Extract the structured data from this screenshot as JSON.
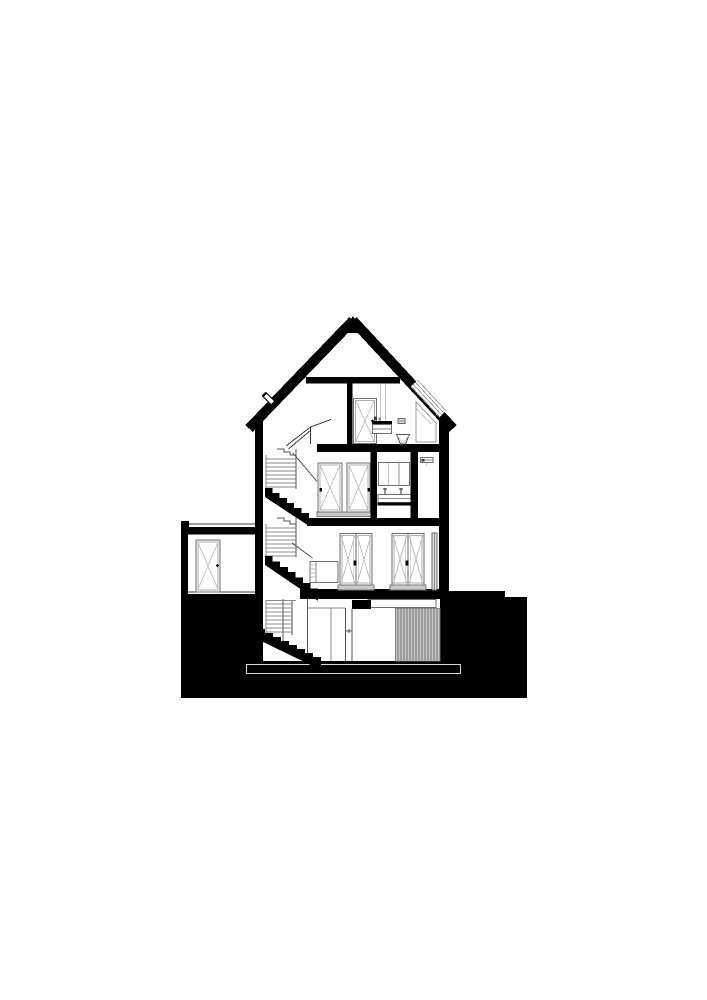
{
  "figure": {
    "kind": "architectural-cross-section",
    "orientation": "portrait",
    "visible_text": [],
    "levels": [
      {
        "name": "attic",
        "features": [
          "gable-roof",
          "collar-tie",
          "roof-window",
          "stair-bulkhead",
          "door",
          "washbasin",
          "wall-hung-wc",
          "flush-panel",
          "chimney-vent"
        ]
      },
      {
        "name": "second-floor",
        "features": [
          "stair-flight",
          "door-left",
          "door-right",
          "mirror-cabinet",
          "vanity-counter",
          "bathroom-wall",
          "closet-shelf"
        ]
      },
      {
        "name": "ground-floor",
        "features": [
          "stair-flight",
          "sideboard",
          "french-door-pair-west",
          "french-door-pair-east",
          "side-window",
          "thresholds"
        ]
      },
      {
        "name": "basement",
        "features": [
          "stair-flight",
          "door",
          "door-lintel",
          "ceiling-beam",
          "hatched-wall-panel",
          "foundation-slab"
        ]
      }
    ],
    "annex": {
      "name": "single-storey-annex",
      "features": [
        "flat-roof",
        "parapet",
        "door"
      ]
    },
    "ground": {
      "representation": "solid-black-poche"
    }
  },
  "colors": {
    "paper": "#ffffff",
    "ink": "#000000",
    "frame_line": "#6e6e6e",
    "light_line": "#b8b8b8",
    "threshold_gray": "#c9c9c9",
    "hatch_gray": "#9d9d9d",
    "hatch_stripe": "#c4c4c4"
  },
  "canvas": {
    "width": 707,
    "height": 1000
  }
}
